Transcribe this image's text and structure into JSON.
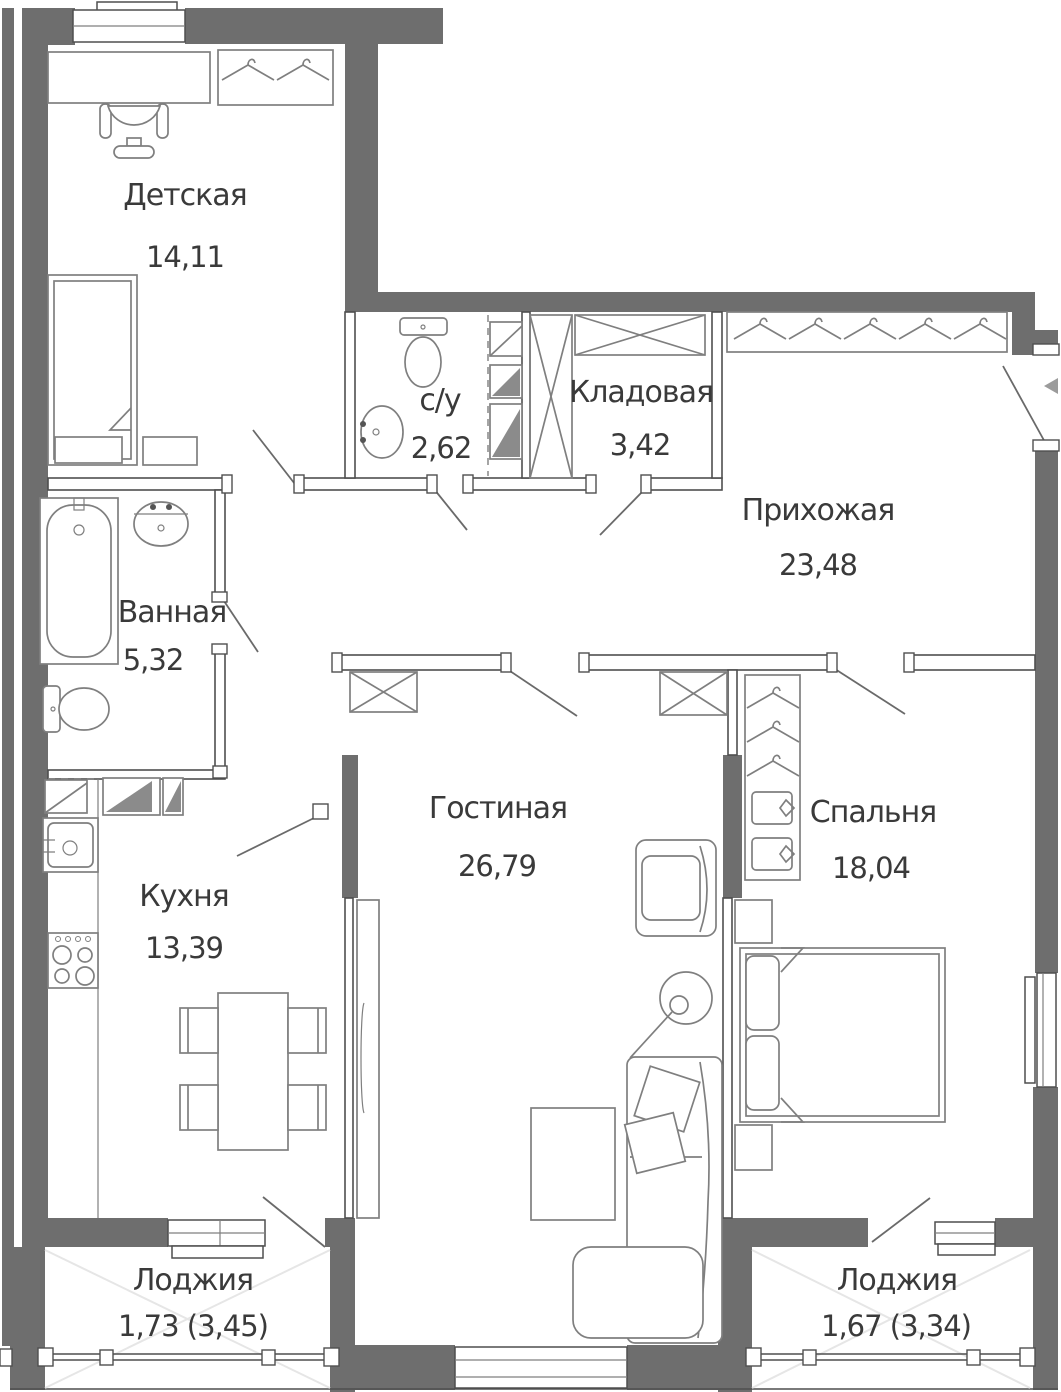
{
  "plan_title": "Apartment floor plan",
  "rooms": [
    {
      "id": "detskaya",
      "name": "Детская",
      "area": "14,11"
    },
    {
      "id": "su",
      "name": "с/у",
      "area": "2,62"
    },
    {
      "id": "kladovaya",
      "name": "Кладовая",
      "area": "3,42"
    },
    {
      "id": "prihozhaya",
      "name": "Прихожая",
      "area": "23,48"
    },
    {
      "id": "vannaya",
      "name": "Ванная",
      "area": "5,32"
    },
    {
      "id": "kuhnya",
      "name": "Кухня",
      "area": "13,39"
    },
    {
      "id": "gostinaya",
      "name": "Гостиная",
      "area": "26,79"
    },
    {
      "id": "spalnya",
      "name": "Спальня",
      "area": "18,04"
    },
    {
      "id": "loggia_left",
      "name": "Лоджия",
      "area": "1,73 (3,45)"
    },
    {
      "id": "loggia_right",
      "name": "Лоджия",
      "area": "1,67 (3,34)"
    }
  ],
  "colors": {
    "wall": "#6e6e6e",
    "partition": "#4f4f4f",
    "furniture": "#7f7f7f",
    "door": "#6a6a6a",
    "text": "#3a3a3a",
    "background": "#ffffff",
    "hatch": "#e6e6e6"
  }
}
